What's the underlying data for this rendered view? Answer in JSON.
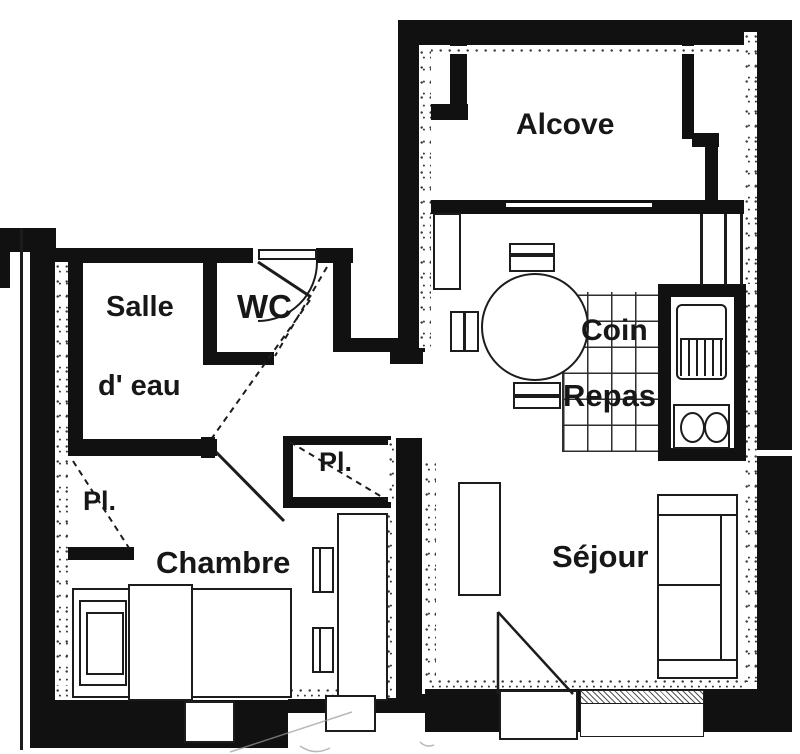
{
  "colors": {
    "ink": "#141414",
    "paper": "#ffffff"
  },
  "rooms": {
    "alcove": {
      "label": "Alcove"
    },
    "salle_eau": {
      "line1": "Salle",
      "line2": "d' eau"
    },
    "wc": {
      "label": "WC"
    },
    "coin_repas": {
      "line1": "Coin",
      "line2": "Repas"
    },
    "closet_left": {
      "label": "Pl."
    },
    "closet_hall": {
      "label": "Pl."
    },
    "chambre": {
      "label": "Chambre"
    },
    "sejour": {
      "label": "Séjour"
    }
  }
}
